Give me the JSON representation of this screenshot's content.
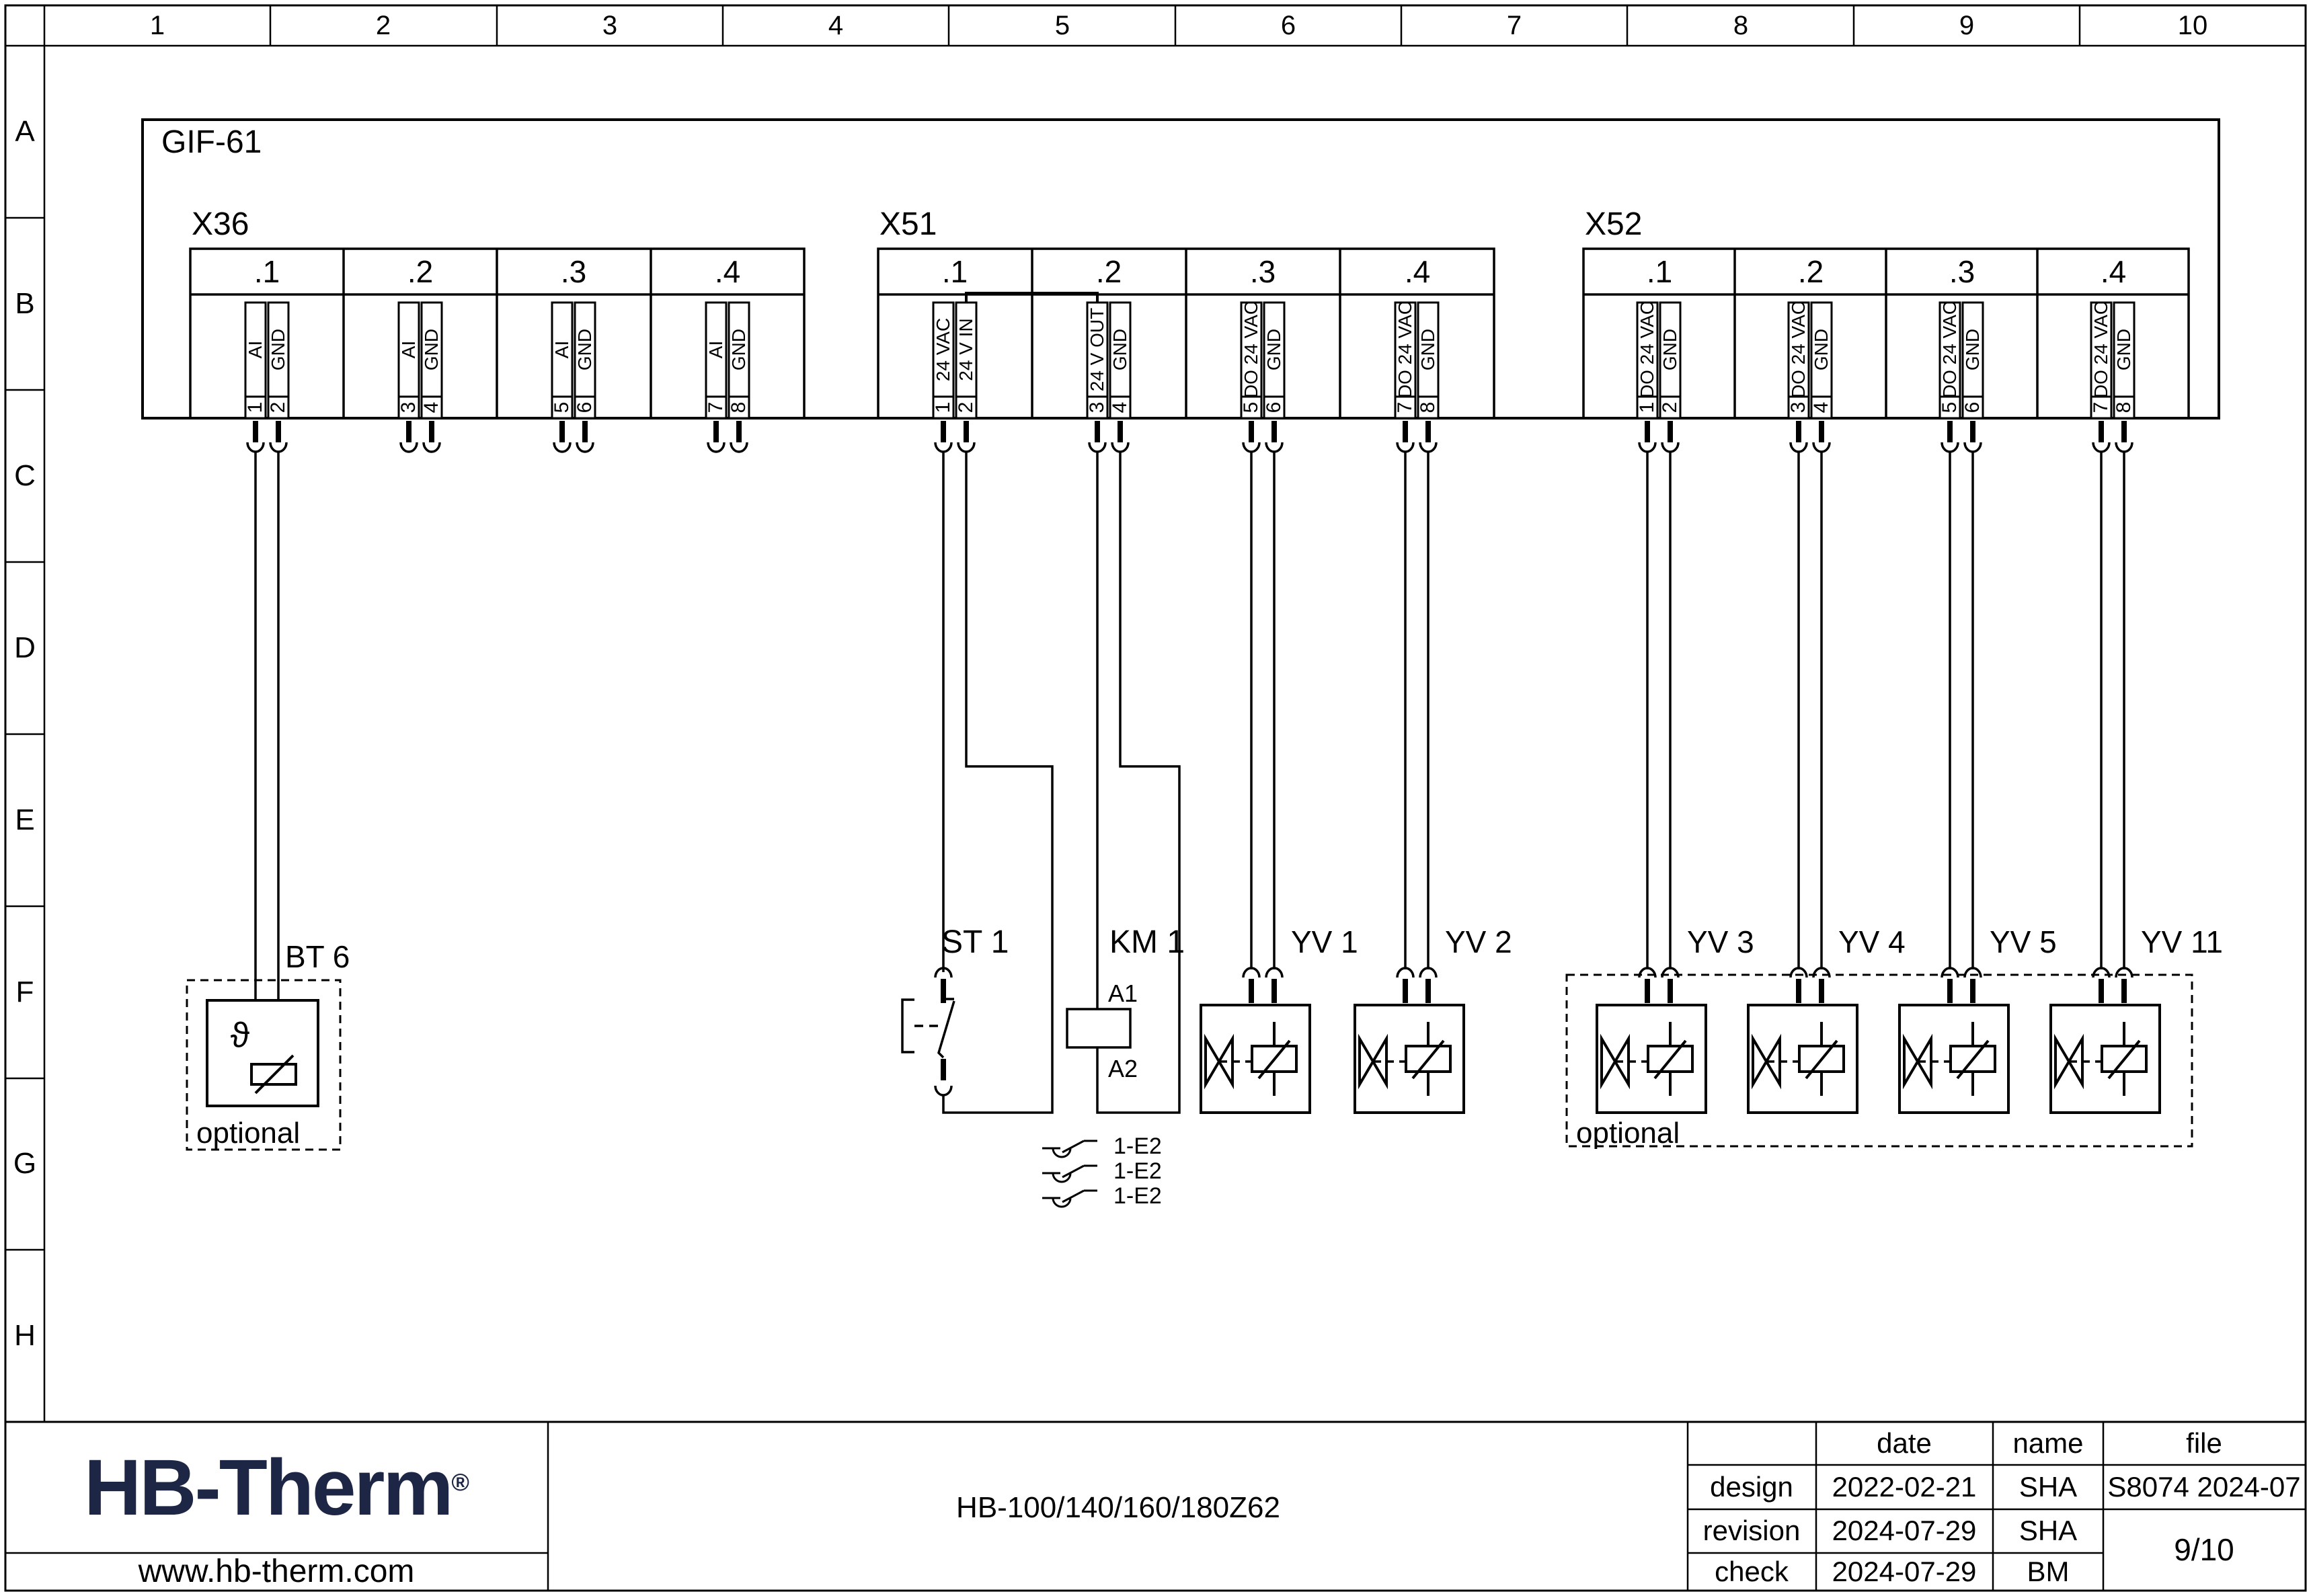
{
  "frame": {
    "columns": [
      "1",
      "2",
      "3",
      "4",
      "5",
      "6",
      "7",
      "8",
      "9",
      "10"
    ],
    "rows": [
      "A",
      "B",
      "C",
      "D",
      "E",
      "F",
      "G",
      "H"
    ]
  },
  "module": {
    "label": "GIF-61"
  },
  "connectors": [
    {
      "label": "X36",
      "sections": [
        ".1",
        ".2",
        ".3",
        ".4"
      ],
      "pins": [
        {
          "number": "1",
          "name": "AI"
        },
        {
          "number": "2",
          "name": "GND"
        },
        {
          "number": "3",
          "name": "AI"
        },
        {
          "number": "4",
          "name": "GND"
        },
        {
          "number": "5",
          "name": "AI"
        },
        {
          "number": "6",
          "name": "GND"
        },
        {
          "number": "7",
          "name": "AI"
        },
        {
          "number": "8",
          "name": "GND"
        }
      ]
    },
    {
      "label": "X51",
      "sections": [
        ".1",
        ".2",
        ".3",
        ".4"
      ],
      "pins": [
        {
          "number": "1",
          "name": "24 VAC"
        },
        {
          "number": "2",
          "name": "24 V IN"
        },
        {
          "number": "3",
          "name": "24 V OUT"
        },
        {
          "number": "4",
          "name": "GND"
        },
        {
          "number": "5",
          "name": "DO 24 VAC"
        },
        {
          "number": "6",
          "name": "GND"
        },
        {
          "number": "7",
          "name": "DO 24 VAC"
        },
        {
          "number": "8",
          "name": "GND"
        }
      ]
    },
    {
      "label": "X52",
      "sections": [
        ".1",
        ".2",
        ".3",
        ".4"
      ],
      "pins": [
        {
          "number": "1",
          "name": "DO 24 VAC"
        },
        {
          "number": "2",
          "name": "GND"
        },
        {
          "number": "3",
          "name": "DO 24 VAC"
        },
        {
          "number": "4",
          "name": "GND"
        },
        {
          "number": "5",
          "name": "DO 24 VAC"
        },
        {
          "number": "6",
          "name": "GND"
        },
        {
          "number": "7",
          "name": "DO 24 VAC"
        },
        {
          "number": "8",
          "name": "GND"
        }
      ]
    }
  ],
  "components": {
    "bt6": {
      "label": "BT 6",
      "symbol": "ϑ",
      "note": "optional"
    },
    "st1": {
      "label": "ST 1"
    },
    "km1": {
      "label": "KM 1",
      "a1": "A1",
      "a2": "A2"
    },
    "valves": [
      {
        "label": "YV 1"
      },
      {
        "label": "YV 2"
      },
      {
        "label": "YV 3"
      },
      {
        "label": "YV 4"
      },
      {
        "label": "YV 5"
      },
      {
        "label": "YV 11"
      }
    ],
    "optional_group": "optional",
    "contacts": [
      {
        "label": "1-E2"
      },
      {
        "label": "1-E2"
      },
      {
        "label": "1-E2"
      }
    ]
  },
  "title_block": {
    "logo": {
      "text": "HB-Therm",
      "reg": "®",
      "color": "#1d2745"
    },
    "website": "www.hb-therm.com",
    "drawing_title": "HB-100/140/160/180Z62",
    "table": {
      "date_header": "date",
      "name_header": "name",
      "file_header": "file",
      "rows": [
        {
          "label": "design",
          "date": "2022-02-21",
          "name": "SHA"
        },
        {
          "label": "revision",
          "date": "2024-07-29",
          "name": "SHA"
        },
        {
          "label": "check",
          "date": "2024-07-29",
          "name": "BM"
        }
      ],
      "file_value": "S8074 2024-07",
      "page": "9/10"
    }
  }
}
